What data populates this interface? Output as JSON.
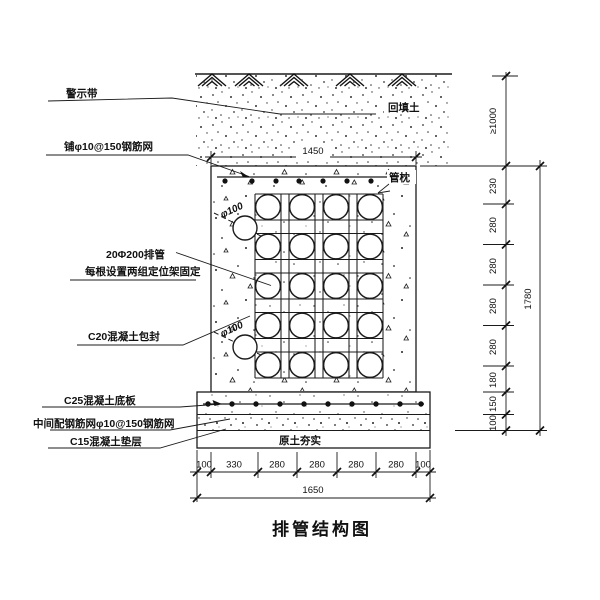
{
  "title": "排管结构图",
  "labels": {
    "warning_tape": "警示带",
    "top_mesh": "铺φ10@150钢筋网",
    "pipes": "20Φ200排管",
    "pipes_note": "每根设置两组定位架固定",
    "c20_encase": "C20混凝土包封",
    "c25_slab": "C25混凝土底板",
    "mid_mesh": "中间配钢筋网φ10@150钢筋网",
    "c15_cushion": "C15混凝土垫层",
    "backfill": "回填土",
    "pipe_pillow": "管枕",
    "compacted_soil": "原土夯实",
    "pipe_dia_upper": "φ100",
    "pipe_dia_lower": "φ100"
  },
  "dimensions": {
    "top_width": "1450",
    "bottom_total": "1650",
    "bottom_segments": [
      "100",
      "330",
      "280",
      "280",
      "280",
      "280",
      "100"
    ],
    "right_depth_min": "≥1000",
    "right_total": "1780",
    "right_segments": [
      "230",
      "280",
      "280",
      "280",
      "280",
      "180",
      "150",
      "100"
    ]
  },
  "colors": {
    "line": "#1b1b1b",
    "background": "#ffffff"
  }
}
